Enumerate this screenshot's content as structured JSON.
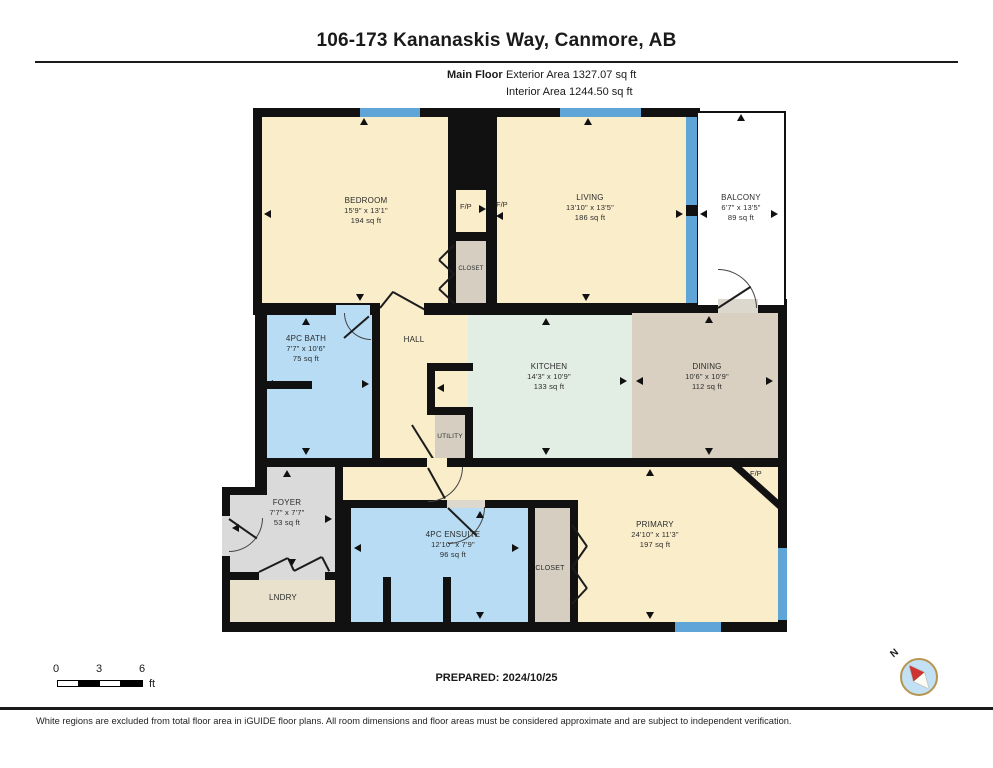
{
  "header": {
    "title": "106-173 Kananaskis Way, Canmore, AB",
    "floor_label": "Main Floor",
    "exterior_area_label": "Exterior Area 1327.07 sq ft",
    "interior_area_label": "Interior Area 1244.50 sq ft"
  },
  "rooms": {
    "bedroom": {
      "name": "BEDROOM",
      "dims": "15'9\" x 13'1\"",
      "area": "194 sq ft"
    },
    "living": {
      "name": "LIVING",
      "dims": "13'10\" x 13'5\"",
      "area": "186 sq ft"
    },
    "balcony": {
      "name": "BALCONY",
      "dims": "6'7\" x 13'5\"",
      "area": "89 sq ft"
    },
    "bath": {
      "name": "4PC BATH",
      "dims": "7'7\" x 10'6\"",
      "area": "75 sq ft"
    },
    "hall": {
      "name": "HALL"
    },
    "kitchen": {
      "name": "KITCHEN",
      "dims": "14'3\" x 10'9\"",
      "area": "133 sq ft"
    },
    "dining": {
      "name": "DINING",
      "dims": "10'6\" x 10'9\"",
      "area": "112 sq ft"
    },
    "utility": {
      "name": "UTILITY"
    },
    "foyer": {
      "name": "FOYER",
      "dims": "7'7\" x 7'7\"",
      "area": "53 sq ft"
    },
    "laundry": {
      "name": "LNDRY"
    },
    "ensuite": {
      "name": "4PC ENSUITE",
      "dims": "12'10\" x 7'9\"",
      "area": "96 sq ft"
    },
    "bedroom_closet": {
      "name": "CLOSET"
    },
    "primary_closet": {
      "name": "CLOSET"
    },
    "primary": {
      "name": "PRIMARY",
      "dims": "24'10\" x 11'3\"",
      "area": "197 sq ft"
    },
    "fireplace_bedroom": {
      "name": "F/P"
    },
    "fireplace_living": {
      "name": "F/P"
    },
    "fireplace_primary": {
      "name": "F/P"
    }
  },
  "scale_bar": {
    "tick_0": "0",
    "tick_3": "3",
    "tick_6": "6",
    "unit": "ft"
  },
  "compass": {
    "north_label": "N"
  },
  "footer": {
    "prepared_label": "PREPARED: 2024/10/25",
    "disclaimer": "White regions are excluded from total floor area in iGUIDE floor plans. All room dimensions and floor areas must be considered approximate and are subject to independent verification."
  },
  "colors": {
    "room_cream": "#faedca",
    "room_blue": "#b7dcf3",
    "room_mint": "#e2ede4",
    "room_tan": "#d9d0c1",
    "room_grey": "#dadada",
    "laundry_tan": "#e9e1cb",
    "window_blue": "#5fa5d8",
    "wall_black": "#111111",
    "compass_fill": "#c3e1f5",
    "compass_needle": "#cc3333"
  }
}
